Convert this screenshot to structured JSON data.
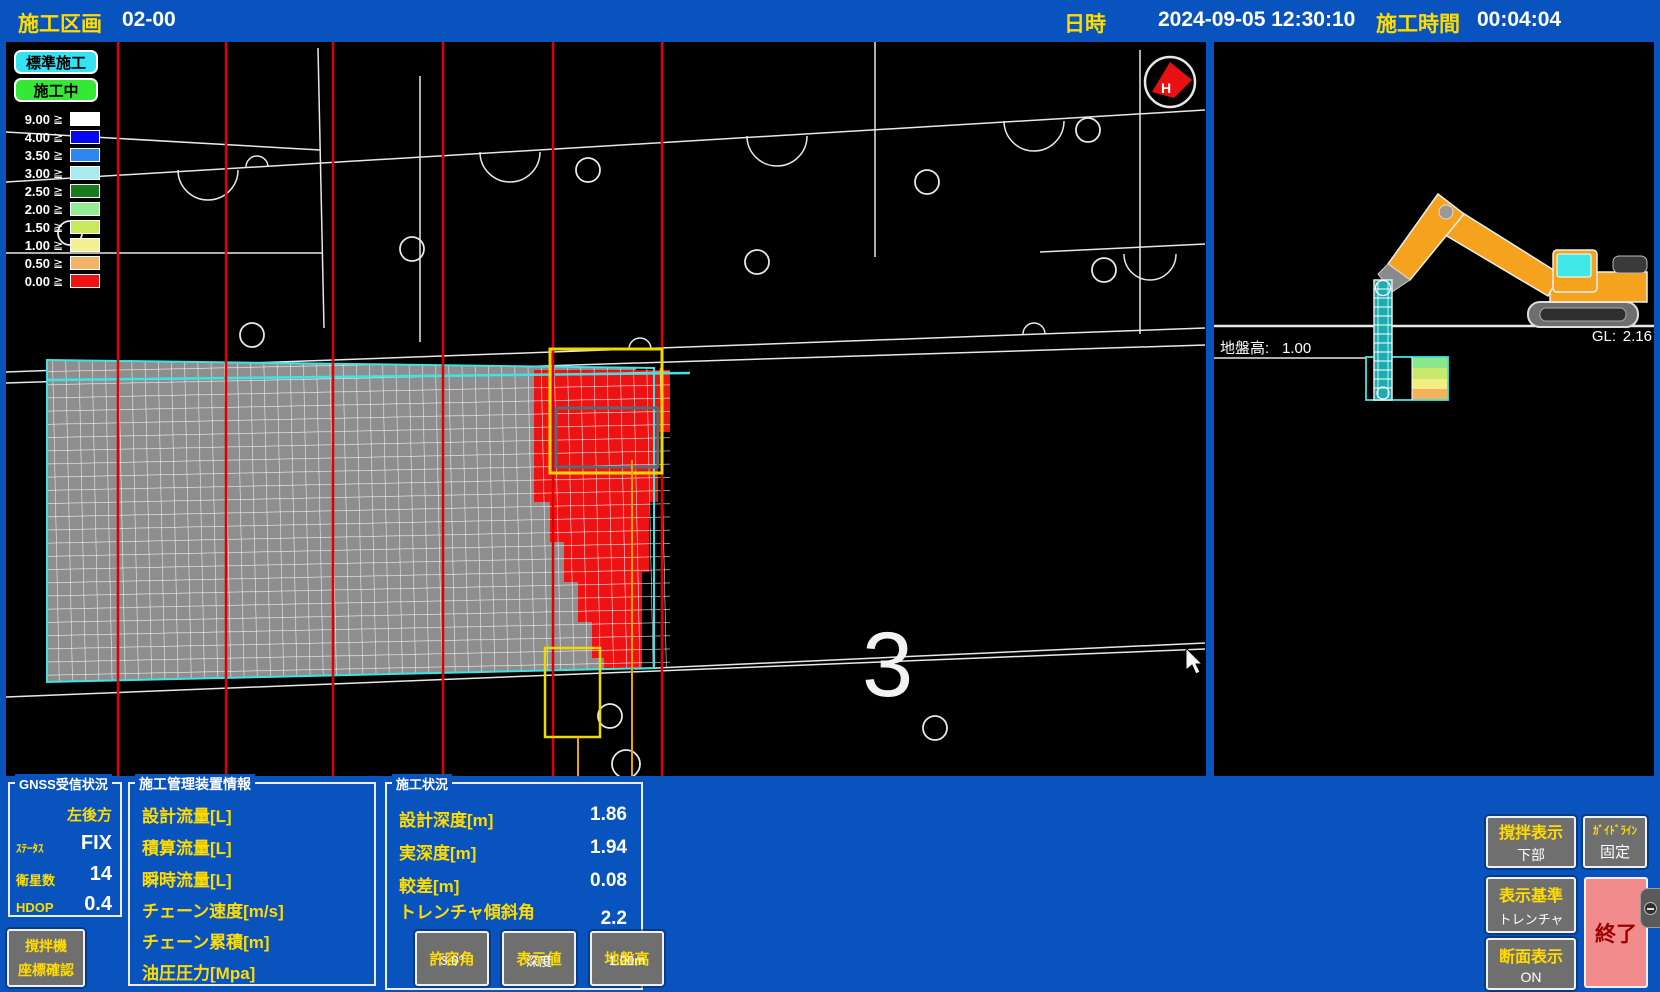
{
  "top_bar": {
    "section_label": "施工区画",
    "section_value": "02-00",
    "datetime_label": "日時",
    "datetime_value": "2024-09-05 12:30:10",
    "elapsed_label": "施工時間",
    "elapsed_value": "00:04:04"
  },
  "plan_view": {
    "mode_buttons": [
      {
        "label": "標準施工",
        "color": "#35E2F2"
      },
      {
        "label": "施工中",
        "color": "#35E835"
      }
    ],
    "legend": {
      "operator": "≧",
      "rows": [
        {
          "value": "9.00",
          "color": "#FFFFFF"
        },
        {
          "value": "4.00",
          "color": "#0808F0"
        },
        {
          "value": "3.50",
          "color": "#2E86F0"
        },
        {
          "value": "3.00",
          "color": "#A9EAF2"
        },
        {
          "value": "2.50",
          "color": "#1B7A1B"
        },
        {
          "value": "2.00",
          "color": "#93EC93"
        },
        {
          "value": "1.50",
          "color": "#C9E85A"
        },
        {
          "value": "1.00",
          "color": "#F2F090"
        },
        {
          "value": "0.50",
          "color": "#F2B468"
        },
        {
          "value": "0.00",
          "color": "#F01212"
        }
      ]
    },
    "zone_number": "3",
    "compass_label": "H"
  },
  "section_view": {
    "ground_label": "地盤高:",
    "ground_value": "1.00",
    "gl_label": "GL:",
    "gl_value": "2.16"
  },
  "gnss_panel": {
    "title": "GNSS受信状況",
    "antenna": "左後方",
    "rows": [
      {
        "label": "ｽﾃｰﾀｽ",
        "value": "FIX"
      },
      {
        "label": "衛星数",
        "value": "14"
      },
      {
        "label": "HDOP",
        "value": "0.4"
      }
    ]
  },
  "mixer_button": {
    "line1": "撹拌機",
    "line2": "座標確認"
  },
  "device_panel": {
    "title": "施工管理装置情報",
    "items": [
      "設計流量[L]",
      "積算流量[L]",
      "瞬時流量[L]",
      "チェーン速度[m/s]",
      "チェーン累積[m]",
      "油圧圧力[Mpa]"
    ]
  },
  "status_panel": {
    "title": "施工状況",
    "rows": [
      {
        "label": "設計深度[m]",
        "value": "1.86"
      },
      {
        "label": "実深度[m]",
        "value": "1.94"
      },
      {
        "label": "較差[m]",
        "value": "0.08"
      },
      {
        "label": "トレンチャ傾斜角",
        "value": "2.2"
      }
    ],
    "buttons": [
      {
        "top": "許容角",
        "bottom": "3.0°"
      },
      {
        "top": "表示値",
        "bottom": "深度"
      },
      {
        "top": "地盤高",
        "bottom": "1.00m"
      }
    ]
  },
  "display_buttons": [
    {
      "top": "撹拌表示",
      "bottom": "下部"
    },
    {
      "top": "ｶﾞｲﾄﾞﾗｲﾝ",
      "bottom": "固定"
    },
    {
      "top": "表示基準",
      "bottom": "トレンチャ"
    },
    {
      "top": "断面表示",
      "bottom": "ON"
    }
  ],
  "exit_button": {
    "label": "終了"
  },
  "colors": {
    "background_blue": "#0853BE",
    "label_yellow": "#FFDC00",
    "button_gray": "#6F6F6F",
    "exit_pink": "#F28C8C",
    "alert_red": "#EE1212",
    "mesh_gray": "#8E8E8E",
    "design_cyan": "#3CE4E4",
    "machine_orange": "#F5A21E"
  }
}
